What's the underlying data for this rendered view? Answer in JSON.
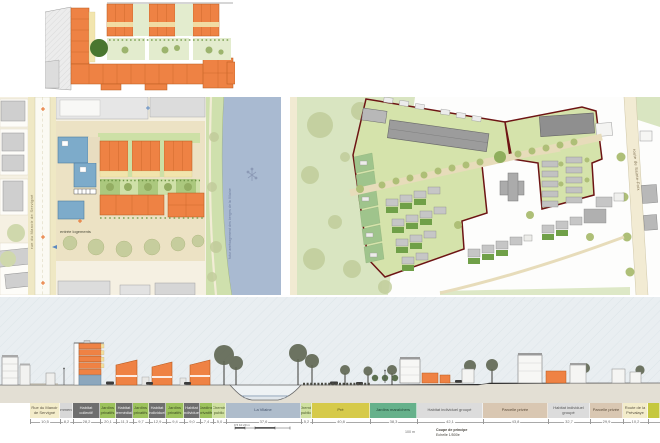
{
  "board": {
    "kind": "urban design presentation board"
  },
  "palette": {
    "orange_building": "#ee8244",
    "orange_outline": "#b85a1e",
    "blue_building": "#7dabca",
    "garden_green": "#a6c878",
    "pale_green": "#cfe0a8",
    "park_green": "#d9e5c1",
    "tree_dark": "#49762f",
    "tree_olive": "#aebf77",
    "river_blue": "#a9bad1",
    "road_cream": "#efe8c4",
    "plaza_beige": "#ece2c4",
    "gray_building": "#c6c6c6",
    "dark_gray_building": "#9a9a9a",
    "site_outline_red": "#6d1414",
    "sky": "#e9eef1"
  },
  "icons": {
    "entrance_marker": "plus-cross",
    "river_symbol": "survey-marker"
  },
  "site_plan_left": {
    "street_label": "rue du Manoir de Servigné",
    "entrance_label": "entrée logements",
    "river_caption": "futur aménagement des berges de la Vilaine"
  },
  "site_plan_right": {
    "road_label": "route de Sainte-Foix"
  },
  "section": {
    "bands": [
      {
        "label": "Rue du Manoir de Servigné",
        "width": 30,
        "bg": "#f3ecca",
        "fg": "#5a5242",
        "dim": "10,5"
      },
      {
        "label": "Commerces",
        "width": 13,
        "bg": "#d8d8d8",
        "fg": "#555555",
        "dim": "8,2"
      },
      {
        "label": "Habitat collectif",
        "width": 27,
        "bg": "#6e6e6e",
        "fg": "#f2f2f2",
        "dim": "28,2"
      },
      {
        "label": "Jardins privatifs",
        "width": 16,
        "bg": "#9cc25c",
        "fg": "#3c4a22",
        "dim": "20,1"
      },
      {
        "label": "Habitat intermédiaire",
        "width": 17,
        "bg": "#6e6e6e",
        "fg": "#f2f2f2",
        "dim": "11,3"
      },
      {
        "label": "Jardins privatifs",
        "width": 16,
        "bg": "#9cc25c",
        "fg": "#3c4a22",
        "dim": "9,7"
      },
      {
        "label": "Habitat individuel",
        "width": 17,
        "bg": "#6e6e6e",
        "fg": "#f2f2f2",
        "dim": "12,9"
      },
      {
        "label": "Jardins privatifs",
        "width": 18,
        "bg": "#9cc25c",
        "fg": "#3c4a22",
        "dim": "9,4"
      },
      {
        "label": "Habitat individuel",
        "width": 16,
        "bg": "#6e6e6e",
        "fg": "#f2f2f2",
        "dim": "9,0"
      },
      {
        "label": "Jardins privatifs",
        "width": 13,
        "bg": "#9cc25c",
        "fg": "#3c4a22",
        "dim": "7,4"
      },
      {
        "label": "Chemin public",
        "width": 13,
        "bg": "#cfe0a0",
        "fg": "#4a5a2a",
        "dim": "5,0"
      },
      {
        "label": "La Vilaine",
        "width": 75,
        "bg": "#aebccb",
        "fg": "#44536b",
        "dim": "37,6"
      },
      {
        "label": "Chemin public",
        "width": 11,
        "bg": "#cfe0a0",
        "fg": "#4a5a2a",
        "dim": "5,2"
      },
      {
        "label": "Pré",
        "width": 58,
        "bg": "#d6ca4a",
        "fg": "#55511e",
        "dim": "40,8"
      },
      {
        "label": "Jardins maraîchers",
        "width": 47,
        "bg": "#66b18b",
        "fg": "#1f4534",
        "dim": "38,3"
      },
      {
        "label": "Habitat individuel groupé",
        "width": 66,
        "bg": "#dcdcdc",
        "fg": "#555555",
        "dim": "42,1"
      },
      {
        "label": "Parcelle privée",
        "width": 65,
        "bg": "#d9c7b2",
        "fg": "#5a4a38",
        "dim": "43,8"
      },
      {
        "label": "Habitat individuel groupé",
        "width": 42,
        "bg": "#dcdcdc",
        "fg": "#555555",
        "dim": "32,7"
      },
      {
        "label": "Parcelle privée",
        "width": 33,
        "bg": "#d9c7b2",
        "fg": "#5a4a38",
        "dim": "29,9"
      },
      {
        "label": "Route de la Prévalaye",
        "width": 25,
        "bg": "#f3ecca",
        "fg": "#5a5242",
        "dim": "10,2"
      },
      {
        "label": "",
        "width": 12,
        "bg": "#c5c83e",
        "fg": "#444444",
        "dim": ""
      }
    ],
    "scale_text": "0    5    10         20 m",
    "note": "100 m",
    "caption_line1": "Coupe de principe",
    "caption_line2": "Echelle 1/500e"
  }
}
